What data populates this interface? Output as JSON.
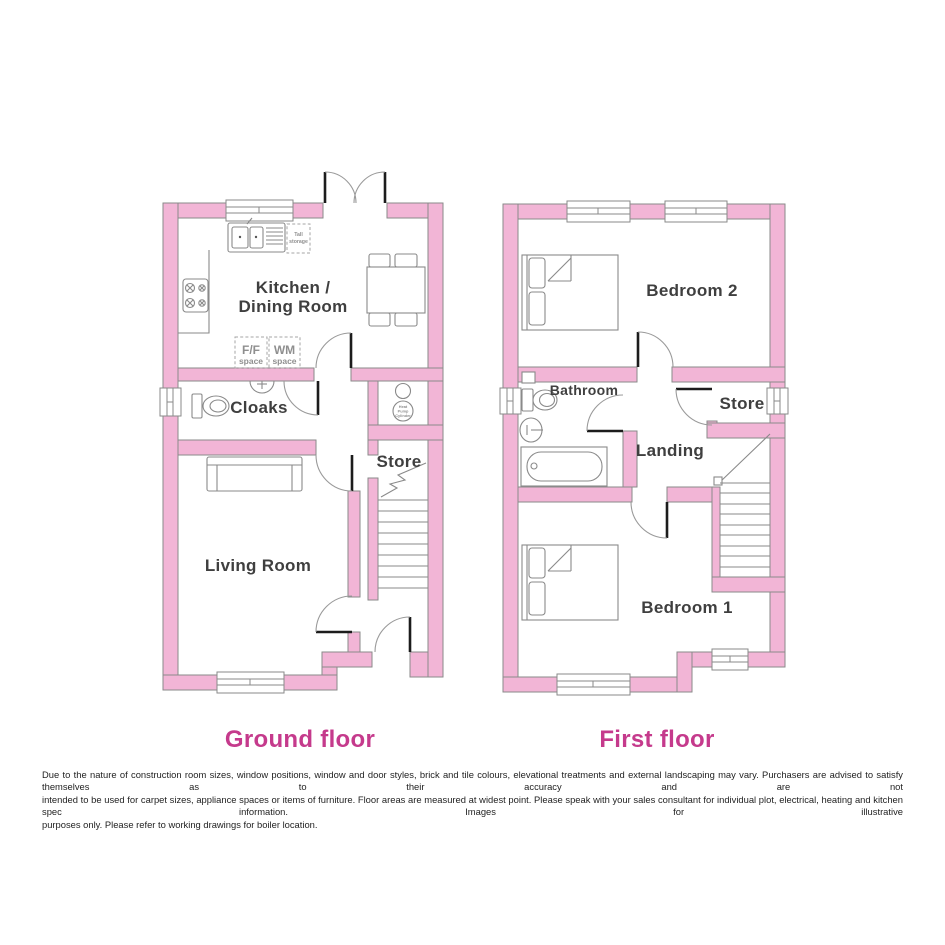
{
  "ground_floor": {
    "title": "Ground floor",
    "rooms": {
      "kitchen_line1": "Kitchen /",
      "kitchen_line2": "Dining Room",
      "cloaks": "Cloaks",
      "store": "Store",
      "living_room": "Living Room"
    },
    "annotations": {
      "tall_storage_l1": "Tall",
      "tall_storage_l2": "storage",
      "ff_l1": "F/F",
      "ff_l2": "space",
      "wm_l1": "WM",
      "wm_l2": "space",
      "hpc_l1": "Heat",
      "hpc_l2": "Pump",
      "hpc_l3": "Cylinder"
    }
  },
  "first_floor": {
    "title": "First floor",
    "rooms": {
      "bedroom2": "Bedroom 2",
      "bathroom": "Bathroom",
      "store": "Store",
      "landing": "Landing",
      "bedroom1": "Bedroom 1"
    }
  },
  "disclaimer": {
    "line1": "Due to the nature of construction room sizes, window positions, window and door styles, brick and tile colours, elevational treatments and external landscaping may vary. Purchasers are advised to satisfy themselves as to their accuracy and are not",
    "line2": "intended to be used for carpet sizes, appliance spaces or items of furniture. Floor areas are measured at widest point. Please speak with your sales consultant for individual plot, electrical, heating and kitchen spec information. Images for illustrative",
    "line3": "purposes only. Please refer to working drawings for boiler location."
  },
  "colors": {
    "wall_pink": "#F2B5D6",
    "line_gray": "#8A8A8A",
    "title_magenta": "#C53A8C",
    "label_gray": "#3F3F3F"
  }
}
